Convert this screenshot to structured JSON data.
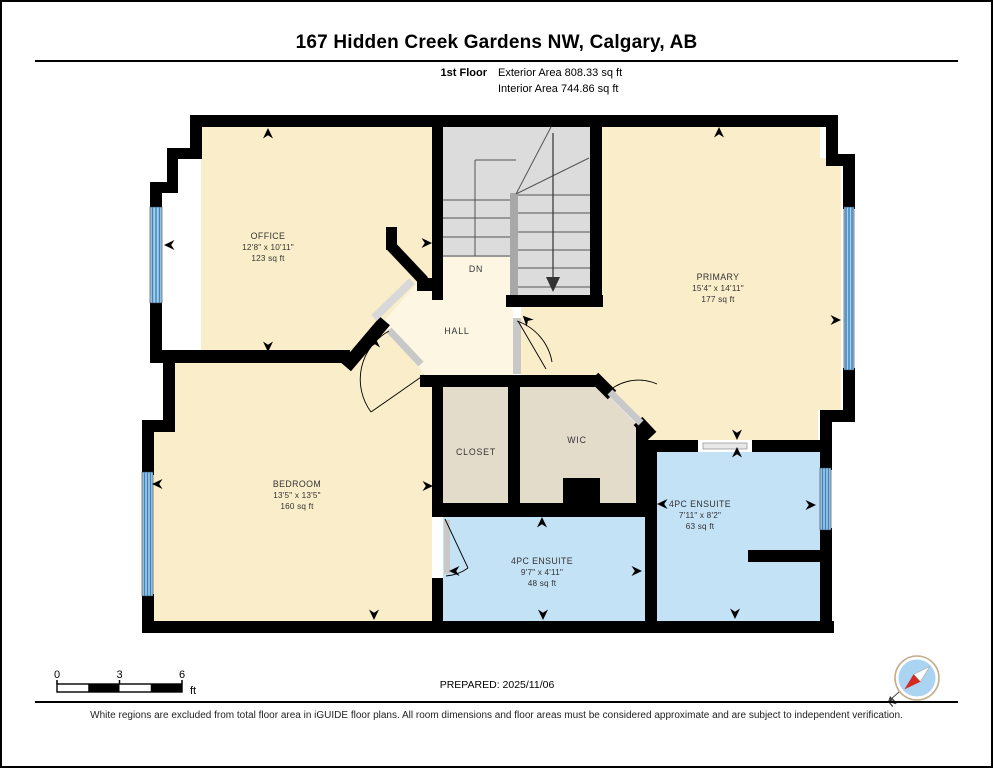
{
  "header": {
    "title": "167 Hidden Creek Gardens NW, Calgary, AB",
    "floor_label": "1st Floor",
    "exterior_area": "Exterior Area 808.33 sq ft",
    "interior_area": "Interior Area 744.86 sq ft"
  },
  "rooms": [
    {
      "name": "OFFICE",
      "dims": "12'8\" x 10'11\"",
      "area": "123 sq ft"
    },
    {
      "name": "PRIMARY",
      "dims": "15'4\" x 14'11\"",
      "area": "177 sq ft"
    },
    {
      "name": "BEDROOM",
      "dims": "13'5\" x 13'5\"",
      "area": "160 sq ft"
    },
    {
      "name": "4PC ENSUITE",
      "dims": "9'7\" x 4'11\"",
      "area": "48 sq ft"
    },
    {
      "name": "4PC ENSUITE",
      "dims": "7'11\" x 8'2\"",
      "area": "63 sq ft"
    },
    {
      "name": "HALL"
    },
    {
      "name": "CLOSET"
    },
    {
      "name": "WIC"
    },
    {
      "name": "DN"
    }
  ],
  "scale_bar": {
    "ticks": [
      "0",
      "3",
      "6"
    ],
    "unit": "ft"
  },
  "prepared_label": "PREPARED: 2025/11/06",
  "compass": {
    "label": "N"
  },
  "disclaimer": "White regions are excluded from total floor area in iGUIDE floor plans. All room dimensions and floor areas must be considered approximate and are subject to independent verification.",
  "colors": {
    "room_fill": "#FAEDC9",
    "hall_fill": "#FCF6E3",
    "closet_fill": "#E4DCCB",
    "ensuite_fill": "#C4E2F6",
    "stair_fill": "#DCDCDC",
    "stair_rail": "#A8A8A8",
    "wall": "#000000",
    "window_fill": "#AACFE9",
    "window_stripe": "#3E85C0",
    "door_leaf": "#C8C8C8",
    "compass_blue": "#ABD4F2",
    "compass_needle_red": "#D42B1E"
  }
}
